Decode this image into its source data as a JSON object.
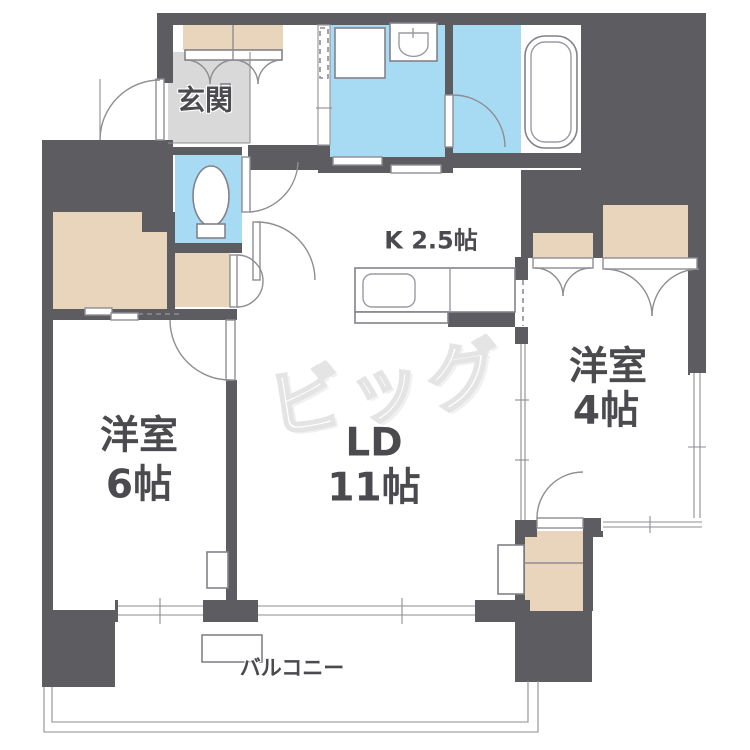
{
  "floorplan": {
    "labels": {
      "genkan": "玄関",
      "kitchen": "K 2.5帖",
      "ld_line1": "LD",
      "ld_line2": "11帖",
      "west6_line1": "洋室",
      "west6_line2": "6帖",
      "west4_line1": "洋室",
      "west4_line2": "4帖",
      "balcony": "バルコニー",
      "watermark": "ビッグ"
    },
    "rooms": [
      {
        "name": "玄関",
        "type": "entrance"
      },
      {
        "name": "K",
        "size_jo": "2.5帖",
        "type": "kitchen"
      },
      {
        "name": "LD",
        "size_jo": "11帖",
        "type": "living-dining"
      },
      {
        "name": "洋室",
        "size_jo": "6帖",
        "type": "western-room"
      },
      {
        "name": "洋室",
        "size_jo": "4帖",
        "type": "western-room"
      },
      {
        "name": "バルコニー",
        "type": "balcony"
      }
    ],
    "colors": {
      "wall": "#5d5d61",
      "water_room": "#a7daf3",
      "closet": "#e8d5bc",
      "entrance_floor": "#d9d9d9",
      "line": "#8e8e93",
      "label_text": "#4b4b4f",
      "watermark": "#e4e4e4"
    }
  }
}
